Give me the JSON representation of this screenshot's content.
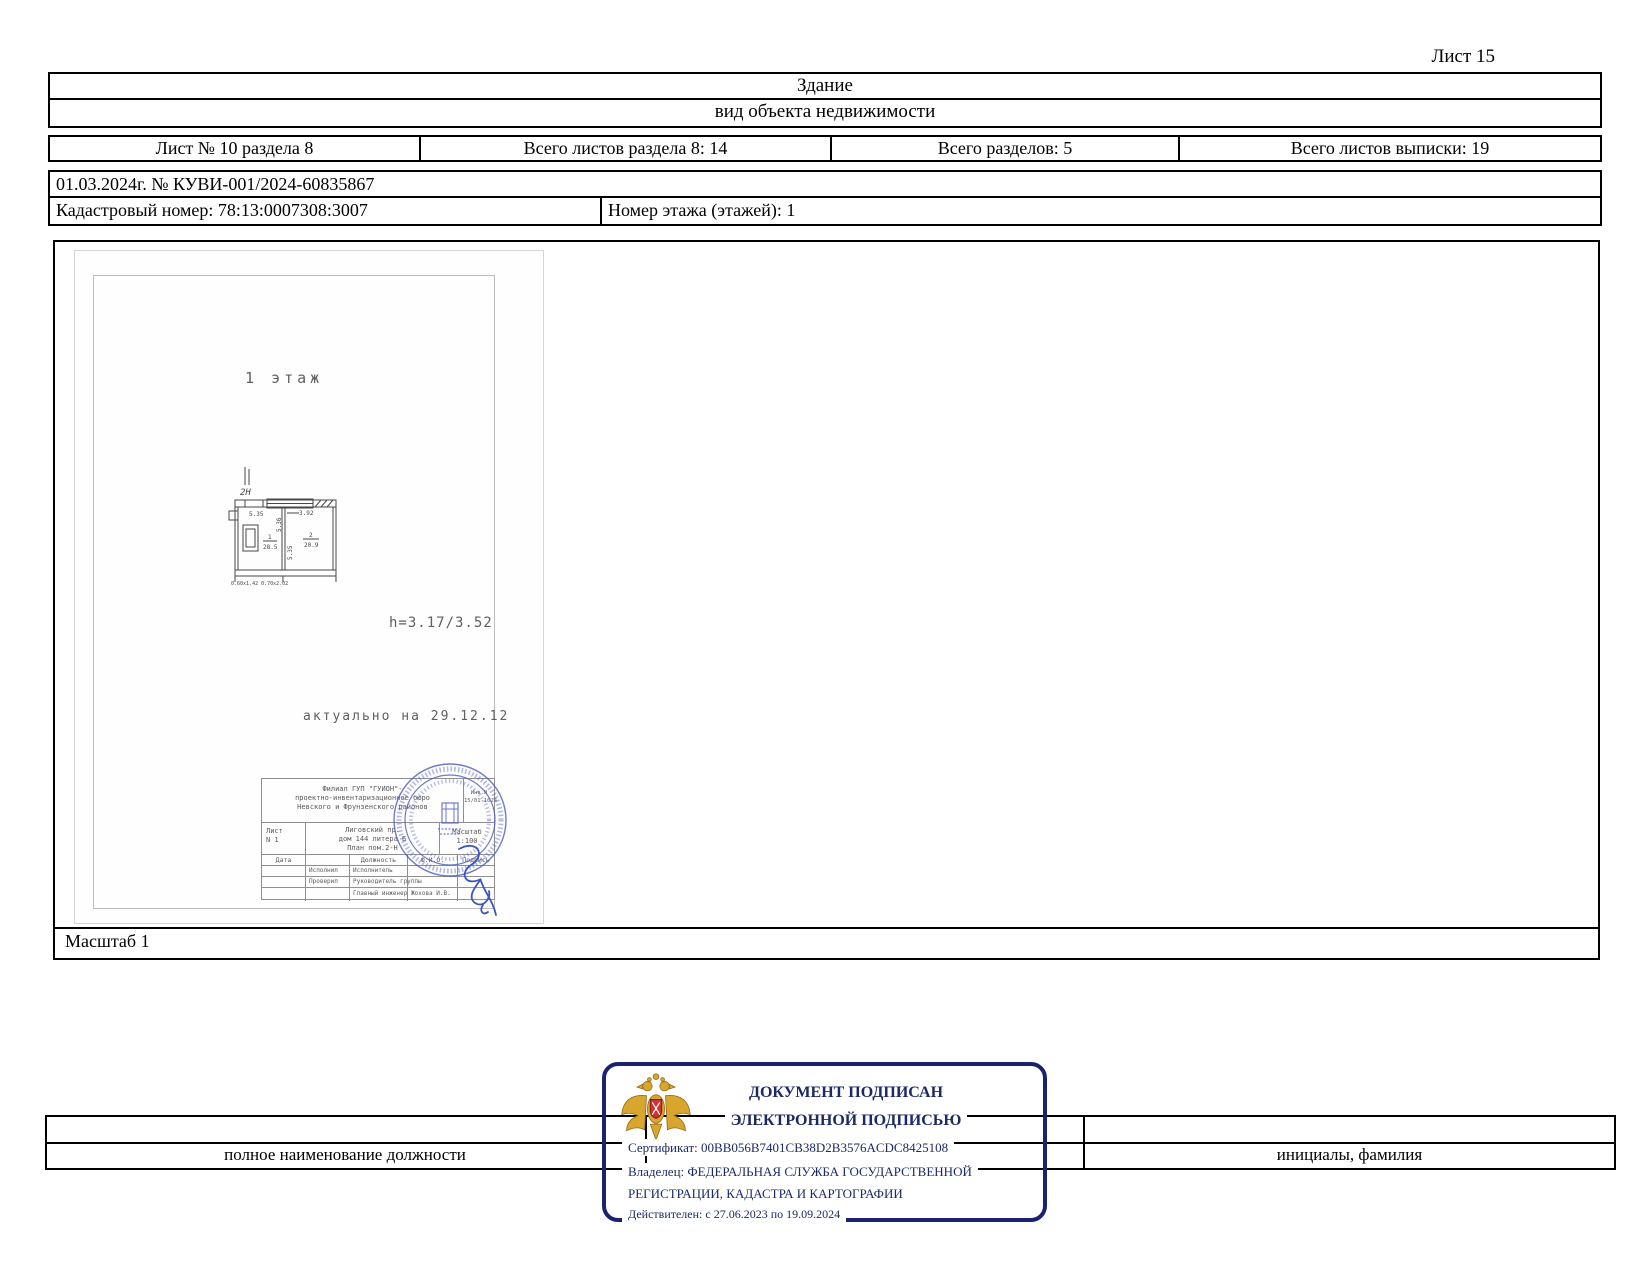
{
  "page": {
    "sheet_label": "Лист 15"
  },
  "colors": {
    "stamp_border": "#1b2370",
    "stamp_text": "#1b2a66",
    "round_seal_blue": "#4d5fc0",
    "eagle_gold": "#d8a62d",
    "eagle_red": "#d23131"
  },
  "header": {
    "object_type": "Здание",
    "object_type_caption": "вид объекта недвижимости",
    "sheet_info": [
      "Лист № 10 раздела 8",
      "Всего листов раздела 8: 14",
      "Всего разделов: 5",
      "Всего листов выписки: 19"
    ],
    "date_number": "01.03.2024г. № КУВИ-001/2024-60835867",
    "cadastral_number": "Кадастровый номер: 78:13:0007308:3007",
    "floor_number": "Номер этажа (этажей): 1"
  },
  "plan": {
    "floor_label": "1 этаж",
    "premise_label": "2Н",
    "dim_top_left": "5.35",
    "dim_top_right": "3.92",
    "dim_mid_vertical": "5.36",
    "dim_left_vertical": "5.35",
    "room1_number": "1",
    "room1_area": "28.5",
    "room2_number": "2",
    "room2_area": "20.9",
    "door_sizes": "0.60х1.42 0.70х2.02",
    "height_note": "h=3.17/3.52",
    "actual_note": "актуально на 29.12.12",
    "scale_label": "Масштаб 1",
    "title_block": {
      "org_line1": "Филиал ГУП \"ГУИОН\"-",
      "org_line2": "проектно-инвентаризационное бюро",
      "org_line3": "Невского и Фрунзенского районов",
      "inv_label": "Инв.N",
      "inv_value": "15/01-1024",
      "sheet_label": "Лист",
      "sheet_value": "N 1",
      "addr_line1": "Лиговский пр.",
      "addr_line2": "дом 144 литера Б",
      "addr_line3": "План  пом.2-Н",
      "scale_head": "Масштаб",
      "scale_value": "1:100",
      "col_date": "Дата",
      "col_position": "Должность",
      "col_fio": "Ф.И.О.",
      "col_sign": "Подпись",
      "row1_left": "Исполнил",
      "row1_pos": "Исполнитель",
      "row2_left": "Проверил",
      "row2_pos": "Руководитель группы",
      "row3_pos": "Главный инженер",
      "row3_fio": "Жохова И.В."
    }
  },
  "signature_stamp": {
    "line1": "ДОКУМЕНТ ПОДПИСАН",
    "line2": "ЭЛЕКТРОННОЙ ПОДПИСЬЮ",
    "certificate": "Сертификат: 00BB056B7401CB38D2B3576ACDC8425108",
    "owner_line1": "Владелец: ФЕДЕРАЛЬНАЯ СЛУЖБА ГОСУДАРСТВЕННОЙ",
    "owner_line2": "РЕГИСТРАЦИИ, КАДАСТРА И КАРТОГРАФИИ",
    "validity": "Действителен: с 27.06.2023 по 19.09.2024"
  },
  "footer": {
    "position_caption": "полное наименование должности",
    "name_caption": "инициалы, фамилия"
  }
}
